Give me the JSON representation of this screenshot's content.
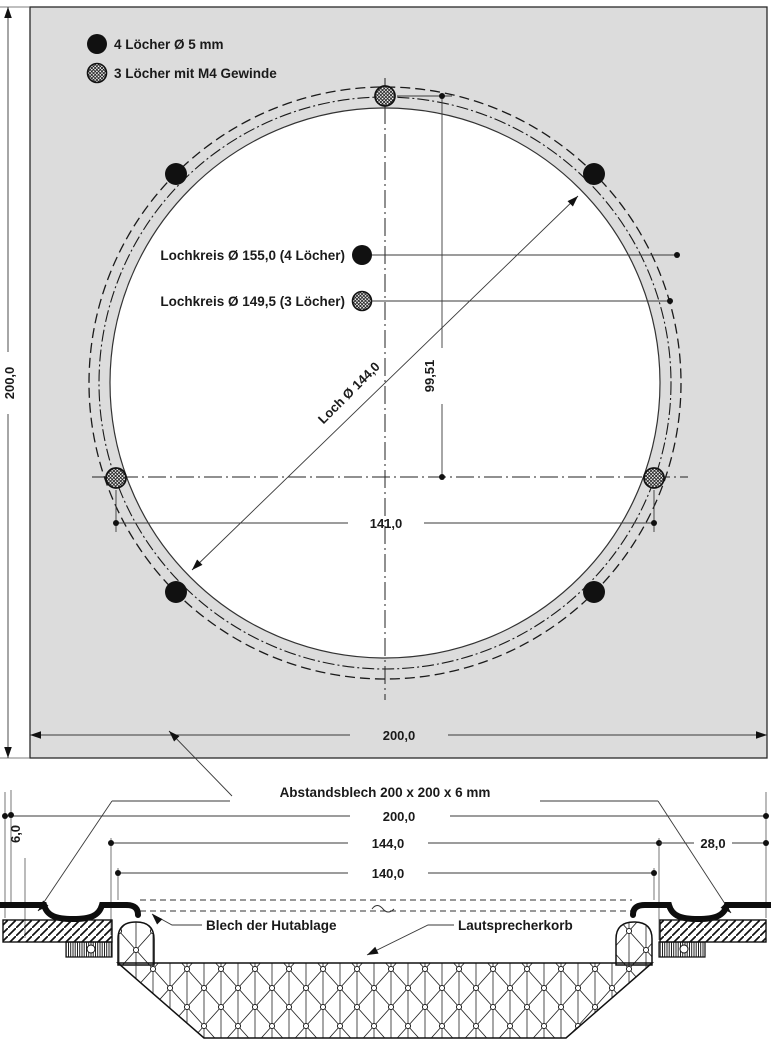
{
  "drawing_title": "Abstandsblech Zeichnung",
  "legend": {
    "hole_5mm": "4 Löcher Ø 5 mm",
    "thread_m4": "3 Löcher mit M4 Gewinde"
  },
  "top_view": {
    "bolt_circle_155_label": "Lochkreis Ø 155,0  (4 Löcher)",
    "bolt_circle_149_label": "Lochkreis Ø 149,5  (3 Löcher)",
    "hole_dia_label": "Loch Ø 144,0",
    "dim_thread_hole_vertical": "99,51",
    "dim_thread_hole_horizontal": "141,0",
    "dim_plate_height": "200,0",
    "dim_plate_width": "200,0"
  },
  "section_view": {
    "spacer_label": "Abstandsblech 200 x 200 x 6 mm",
    "dim_plate_width": "200,0",
    "dim_spacer_hole": "144,0",
    "dim_shelf_opening": "140,0",
    "dim_thickness": "6,0",
    "dim_edge_margin": "28,0",
    "shelf_label": "Blech der Hutablage",
    "basket_label": "Lautsprecherkorb"
  },
  "colors": {
    "plate_fill": "#dcdcdc",
    "line": "#000000",
    "background": "#ffffff"
  }
}
